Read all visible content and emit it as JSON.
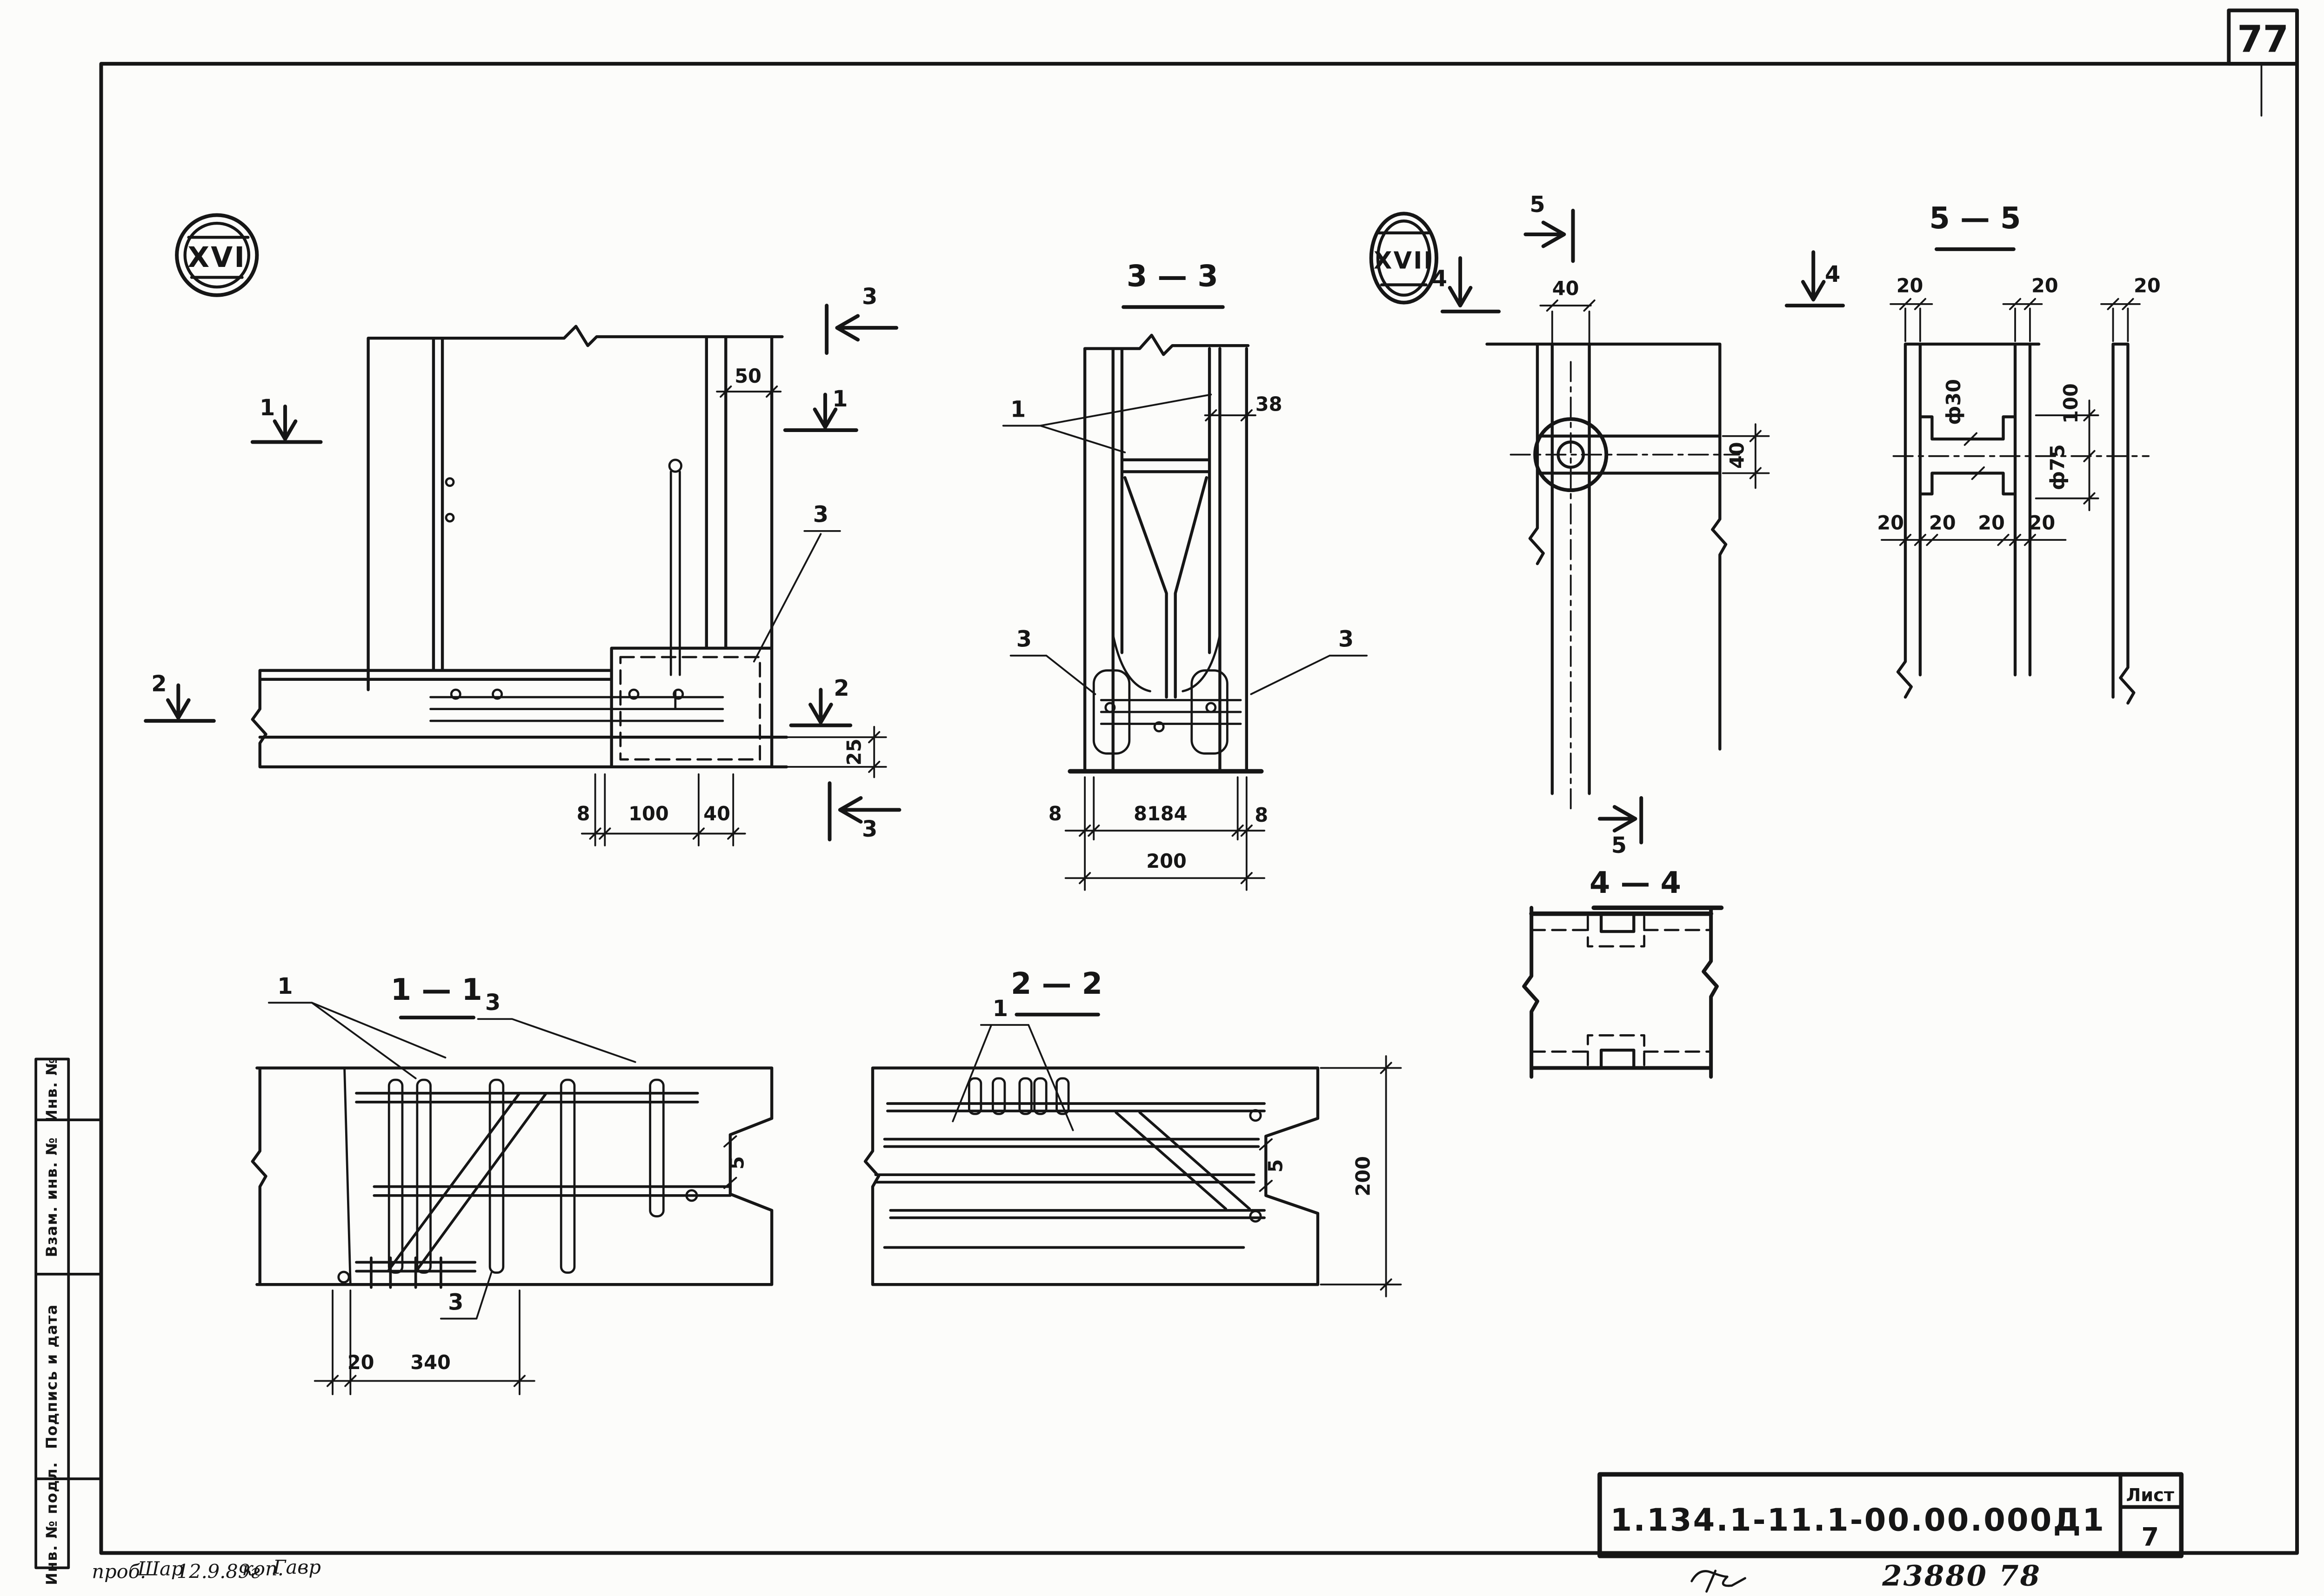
{
  "page": {
    "corner_number": "77",
    "doc_number": "1.134.1-11.1-00.00.000Д1",
    "sheet_label": "Лист",
    "sheet_number": "7",
    "handwritten_number": "23880 78",
    "notes": {
      "prov": "проб.",
      "sign1": "Шар",
      "date": "12.9.89г",
      "kop": "коп.",
      "sign2": "Гавр"
    }
  },
  "side_column": {
    "cells": [
      "Инв. №",
      "Взам. инв. №",
      "Подпись и дата",
      "Инв. № подл."
    ]
  },
  "badges": {
    "xvi": "XVI",
    "xvii": "XVII"
  },
  "view_xvi": {
    "mark_1_left": "1",
    "mark_1_right": "1",
    "mark_2_left": "2",
    "mark_2_right": "2",
    "mark_3_top": "3",
    "mark_3_bottom": "3",
    "callout_3": "3",
    "dim_50": "50",
    "dim_25": "25",
    "dim_8": "8",
    "dim_100": "100",
    "dim_40": "40"
  },
  "view_33": {
    "title": "3 — 3",
    "callout_1": "1",
    "callout_3_left": "3",
    "callout_3_right": "3",
    "dim_38": "38",
    "dim_8_left": "8",
    "dim_184": "8184",
    "dim_8_right": "8",
    "dim_200": "200"
  },
  "view_xvii": {
    "mark_4_left": "4",
    "mark_4_right": "4",
    "mark_5_top": "5",
    "mark_5_bottom": "5",
    "dim_40_top": "40",
    "dim_40_right": "40"
  },
  "view_55": {
    "title": "5 — 5",
    "dim_20_top_left": "20",
    "dim_20_top_mid": "20",
    "dim_20_top_right": "20",
    "dim_20_bot_1": "20",
    "dim_20_bot_2": "20",
    "dim_20_bot_3": "20",
    "dim_20_bot_4": "20",
    "dim_f30": "ф30",
    "dim_f75": "ф75",
    "dim_100": "100"
  },
  "view_44": {
    "title": "4 — 4"
  },
  "view_11": {
    "title": "1 — 1",
    "callout_1": "1",
    "callout_3_top": "3",
    "callout_3_bottom": "3",
    "dim_20": "20",
    "dim_340": "340",
    "dim_5": "5"
  },
  "view_22": {
    "title": "2 — 2",
    "callout_1": "1",
    "dim_200": "200",
    "dim_5": "5"
  }
}
